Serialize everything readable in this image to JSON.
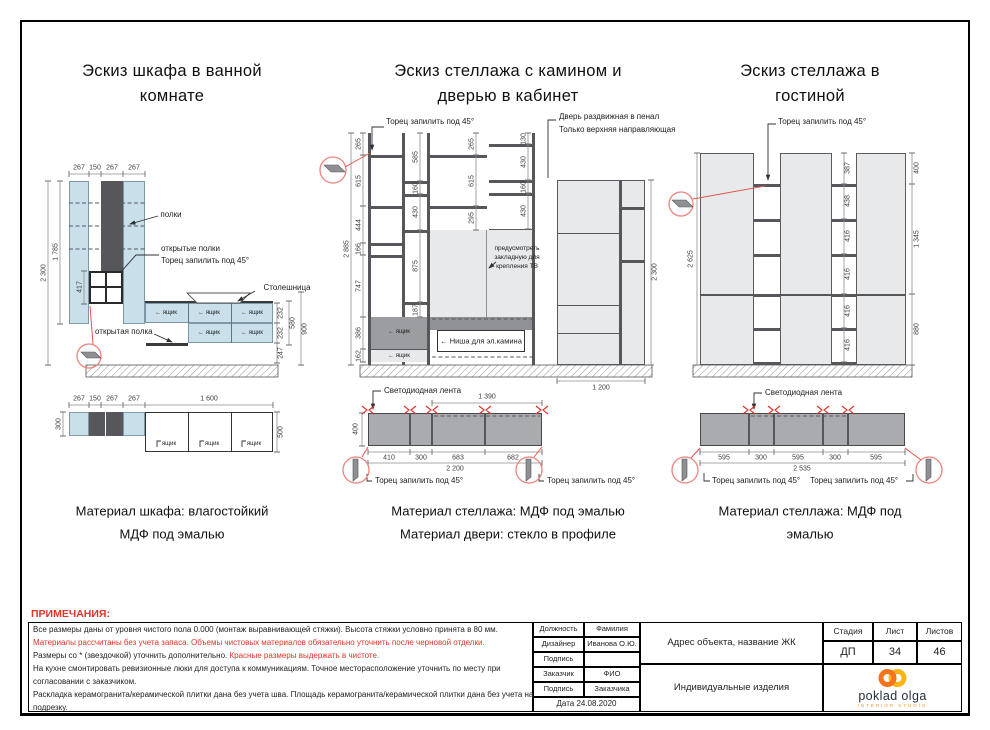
{
  "shared": {
    "miter_label": "Торец запилить под 45°",
    "led_label": "Светодиодная лента",
    "drawer": "ящик",
    "drawer_arrow": "← ящик",
    "colors": {
      "accent_red": "#e0352b",
      "panel_blue": "#c9dfe9",
      "panel_gray": "#e8e9ea",
      "dark_gray": "#55575b",
      "logo_orange": "#f7941d",
      "logo_navy": "#25303c"
    }
  },
  "sk1": {
    "title_line1": "Эскиз шкафа в ванной",
    "title_line2": "комнате",
    "label_shelves": "полки",
    "label_open_shelves": "открытые полки",
    "label_countertop": "Столешница",
    "label_open_shelf": "открытая полка",
    "dim_top": [
      "267",
      "150",
      "267",
      "267"
    ],
    "dim_height_total": "2 300",
    "dim_height_upper": "1 785",
    "dim_grid": "417",
    "dim_right": [
      "232",
      "232",
      "247",
      "580",
      "900"
    ],
    "plan": {
      "dim_len": "1 600",
      "dim_depth_left": "300",
      "dim_depth_right": "500"
    },
    "caption_line1": "Материал шкафа: влагостойкий",
    "caption_line2": "МДФ под эмалью"
  },
  "sk2": {
    "title_line1": "Эскиз стеллажа с камином и",
    "title_line2": "дверью в кабинет",
    "door_note_line1": "Дверь раздвижная в пенал",
    "door_note_line2": "Только верхняя направляющая",
    "tv_note_line1": "предусмотреть",
    "tv_note_line2": "закладную для",
    "tv_note_line3": "крепления ТВ",
    "fireplace_label": "← Ниша для эл.камина",
    "dim_total_h": "2 885",
    "dim_colA": [
      "265",
      "615",
      "444",
      "166",
      "747",
      "386",
      "162"
    ],
    "dim_colB": [
      "585",
      "160",
      "430",
      "875",
      "187"
    ],
    "dim_colC": [
      "265",
      "615",
      "295"
    ],
    "dim_colD": [
      "130",
      "430",
      "160",
      "430"
    ],
    "door_dim_h": "2 300",
    "door_dim_w": "1 200",
    "plan": {
      "dim_top": "1 390",
      "dim_depth": "400",
      "dim_bottom": [
        "410",
        "300",
        "683",
        "682"
      ],
      "dim_total": "2 200"
    },
    "caption_line1": "Материал стеллажа: МДФ под эмалью",
    "caption_line2": "Материал двери: стекло в профиле"
  },
  "sk3": {
    "title_line1": "Эскиз стеллажа в",
    "title_line2": "гостиной",
    "dim_total_h": "2 625",
    "dim_col": [
      "387",
      "438",
      "416",
      "416",
      "416",
      "416"
    ],
    "dim_right": [
      "400",
      "1 345",
      "880"
    ],
    "plan": {
      "dim_bottom": [
        "595",
        "300",
        "595",
        "300",
        "595"
      ],
      "dim_total": "2 535"
    },
    "caption_line1": "Материал стеллажа: МДФ под",
    "caption_line2": "эмалью"
  },
  "notes": {
    "heading": "ПРИМЕЧАНИЯ:",
    "line1": "Все размеры даны от уровня чистого пола 0.000 (монтаж выравнивающей стяжки). Высота стяжки условно принята в 80 мм.",
    "line2": "Материалы рассчитаны без учета запаса. Объемы чистовых материалов обязательно уточнить после черновой отделки.",
    "line3_black": "Размеры со * (звездочкой) уточнить дополнительно.",
    "line3_red": "Красные размеры выдержать в чистоте.",
    "line4": "На кухне смонтировать ревизионные люки для доступа к коммуникациям. Точное месторасположение уточнить по месту при",
    "line5": "согласовании с заказчиком.",
    "line6": "Раскладка керамогранита/керамической плитки дана без учета шва. Площадь керамогранита/керамической плитки дана без учета на",
    "line7": "подрезку."
  },
  "titleblock": {
    "role_header": "Должность",
    "name_header": "Фамилия",
    "designer_label": "Дизайнер",
    "designer_name": "Иванова О.Ю.",
    "signature_label": "Подпись",
    "client_label": "Заказчик",
    "client_name": "ФИО",
    "client_sign": "Заказчика",
    "date_label": "Дата 24.08.2020",
    "address_label": "Адрес объекта, название ЖК",
    "product_label": "Индивидуальные изделия",
    "stage_header": "Стадия",
    "sheet_header": "Лист",
    "sheets_header": "Листов",
    "stage_value": "ДП",
    "sheet_value": "34",
    "sheets_value": "46",
    "logo_text": "poklad olga",
    "logo_sub": "INTERIOR STUDIO"
  }
}
